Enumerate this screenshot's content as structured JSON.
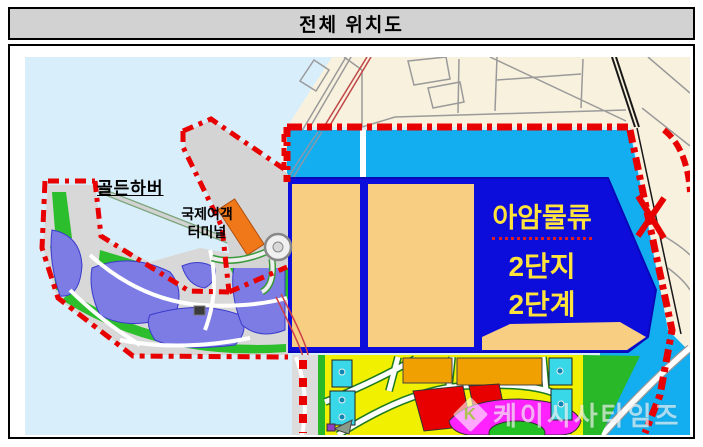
{
  "title": "전체 위치도",
  "map": {
    "labels": {
      "golden_harbor": "골든하버",
      "terminal_line1": "국제여객",
      "terminal_line2": "터미널",
      "logistics_line1": "아암물류",
      "logistics_line2": "2단지",
      "logistics_line3": "2단계"
    },
    "watermark": {
      "logo": "K",
      "text": "케이시사타임즈"
    },
    "colors": {
      "sea": "#d9eefb",
      "land": "#f8f1de",
      "harbor_zone": "#12aeef",
      "site": "#0d0ddb",
      "site_border": "#0808b8",
      "blocks": "#f7ce82",
      "boundary_red": "#e80000",
      "district_yellow": "#f0f000",
      "district_orange": "#f0a000",
      "district_red": "#e80000",
      "district_magenta": "#ff22ff",
      "park_green": "#28b828",
      "pond_purple": "#7c7ce4",
      "pier_gray": "#d4d4d4",
      "terminal_orange": "#f07818",
      "label_yellow": "#ffe33c"
    }
  }
}
